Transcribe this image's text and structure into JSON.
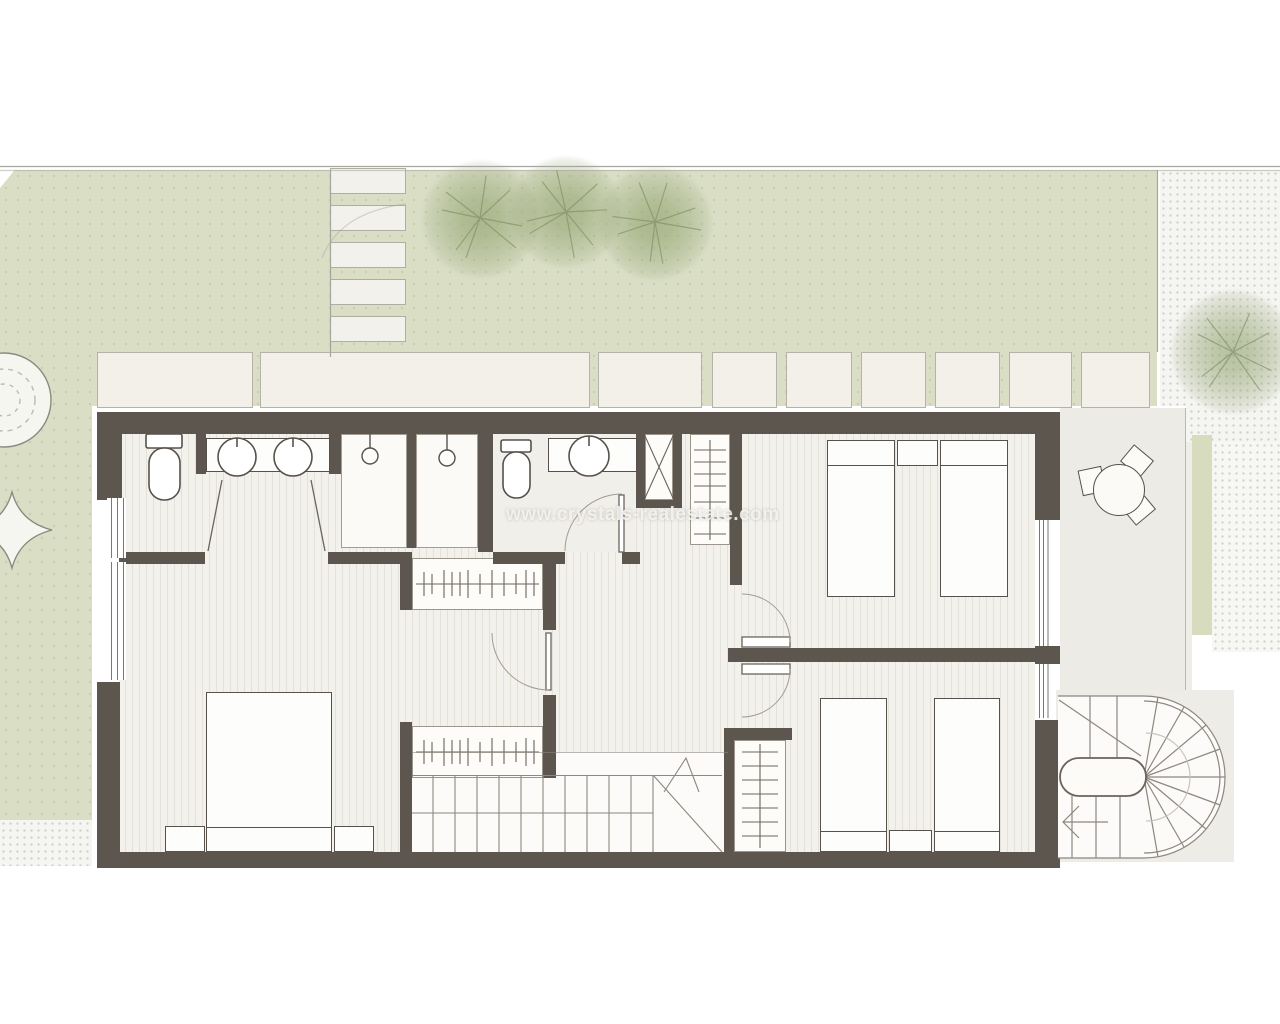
{
  "watermark": {
    "text": "www.crystals-realestate.com"
  },
  "palette": {
    "wall": "#5d564e",
    "floor": "#f3f1ec",
    "floor_stripe": "#e4e1d8",
    "garden": "#d9dec5",
    "slab": "#f2f0e9",
    "terrace": "#edebe6",
    "tree": "#8a9c64",
    "outline": "#57514b",
    "light_line": "#9a948b"
  },
  "inventory": {
    "rooms": [
      "bathroom",
      "shower",
      "shower",
      "wc",
      "hallway",
      "master-bedroom",
      "twin-bedroom-north",
      "twin-bedroom-south",
      "terrace",
      "garden"
    ],
    "fixtures": [
      "toilet",
      "toilet",
      "double-sink-vanity",
      "single-sink-vanity",
      "shower-head",
      "shower-head",
      "utility-shaft",
      "linen-closet",
      "wardrobe",
      "wardrobe",
      "wardrobe"
    ],
    "furniture": [
      "double-bed",
      "nightstand",
      "nightstand",
      "single-bed",
      "single-bed",
      "nightstand",
      "single-bed",
      "single-bed",
      "nightstand",
      "round-table",
      "chair",
      "chair",
      "chair"
    ],
    "circulation": [
      "main-staircase",
      "spiral-staircase",
      "stepping-stones",
      "paved-slab-path"
    ],
    "landscape": [
      "lawn",
      "tree",
      "tree",
      "tree",
      "bush",
      "ornamental-tree",
      "gravel-strip"
    ]
  }
}
